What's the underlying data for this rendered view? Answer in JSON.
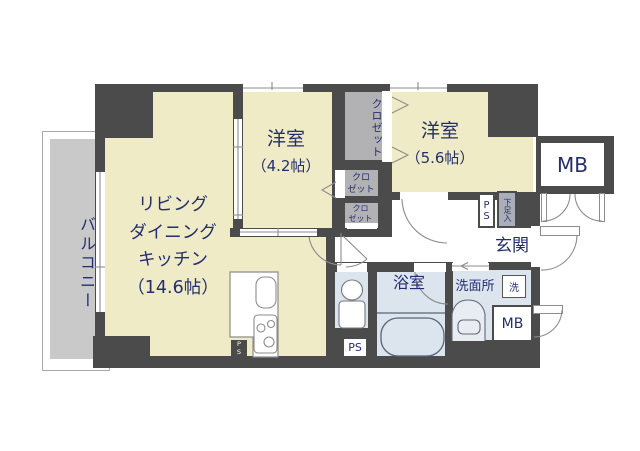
{
  "fp": {
    "rooms": {
      "balcony": {
        "label": "バルコニー"
      },
      "ldk": {
        "line1": "リビング",
        "line2": "ダイニング",
        "line3": "キッチン",
        "size": "（14.6帖）"
      },
      "bedroom_a": {
        "label": "洋室",
        "size": "（4.2帖）"
      },
      "bedroom_b": {
        "label": "洋室",
        "size": "（5.6帖）"
      },
      "entrance": {
        "label": "玄関"
      },
      "bathroom": {
        "label": "浴室"
      },
      "washroom": {
        "label": "洗面所"
      },
      "closet_top": {
        "label": "クロゼット"
      },
      "closet_mid": {
        "line1": "クロ",
        "line2": "ゼット"
      },
      "closet_bottom": {
        "line1": "クロ",
        "line2": "ゼット"
      }
    },
    "labels": {
      "meter_box_top": "MB",
      "meter_box_bottom": "MB",
      "pipe_space_entrance_p": "P",
      "pipe_space_entrance_s": "S",
      "pipe_space_bath": "PS",
      "pipe_space_kitchen_p": "P",
      "pipe_space_kitchen_s": "S",
      "shoe_cabinet": "下足入",
      "washing_machine": "洗"
    },
    "colors": {
      "wall": "#4b4b4b",
      "room_floor": "#f0ebc7",
      "wet_floor": "#dce4ed",
      "balcony": "#c9c9c9",
      "closet": "#b2b2b5",
      "text": "#242e6e"
    }
  }
}
